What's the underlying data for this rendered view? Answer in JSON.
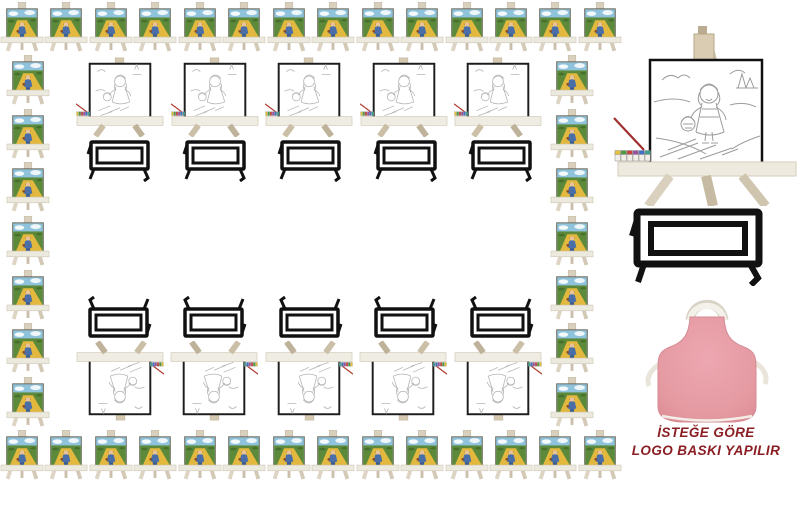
{
  "page": {
    "width": 800,
    "height": 509,
    "background": "#ffffff",
    "description": "mini painted canvas easel set product collage"
  },
  "border_rows": {
    "top_count": 14,
    "bottom_count": 14,
    "left_count": 7,
    "right_count": 7,
    "item_label": "mini-easel-with-painted-canvas"
  },
  "center": {
    "sketch_easels_top_count": 5,
    "tables_top_count": 5,
    "tables_bottom_count": 5,
    "sketch_easels_bottom_count": 5
  },
  "featured": {
    "easel_label": "large-easel-with-coloring-canvas",
    "table_label": "black-table-outline",
    "apron_label": "pink-apron"
  },
  "caption": {
    "line1": "İSTEĞE GÖRE",
    "line2": "LOGO BASKI YAPILIR",
    "color": "#8a1e22"
  },
  "palette": {
    "easel_wood": "#d8cfbd",
    "tray": "#ece8dc",
    "canvas_sky": "#8fc3dc",
    "canvas_grass": "#5c8a3a",
    "canvas_path_yellow": "#e3b83e",
    "girl_dress_blue": "#4a6fa8",
    "sketch_line_gray": "#a8a8a8",
    "outline_black": "#111111",
    "apron_pink": "#e59aa2",
    "strap_white": "#eae6dc",
    "paint_pot_colors": [
      "#e6c23a",
      "#4f9a3f",
      "#c94040",
      "#9a4fa0",
      "#3f6fc9",
      "#3fa08f"
    ],
    "brush_red": "#b03a2e"
  }
}
